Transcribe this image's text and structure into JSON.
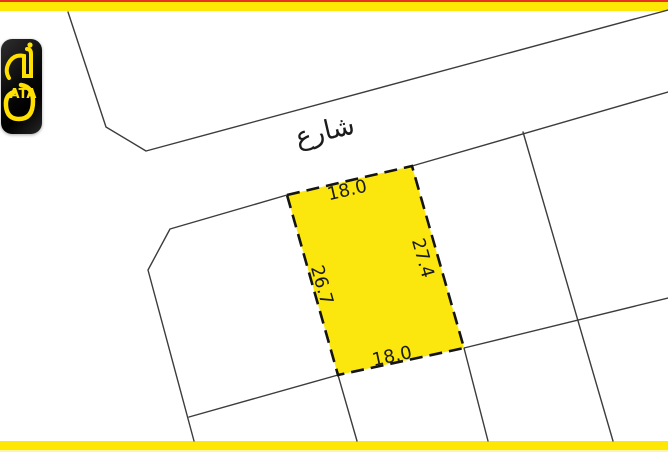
{
  "colors": {
    "stripe_yellow": "#ffe705",
    "stripe_red": "#e63328",
    "plot_fill": "#fbe70e",
    "plot_border": "#141414",
    "boundary_line": "#3c3c3c",
    "logo_bg": "#000000",
    "logo_glyph": "#ffe000"
  },
  "logo": {
    "text": "ATA"
  },
  "map": {
    "street_label": "شارع",
    "plot": {
      "top": "18.0",
      "right": "27.4",
      "left": "26.7",
      "bottom": "18.0"
    }
  }
}
